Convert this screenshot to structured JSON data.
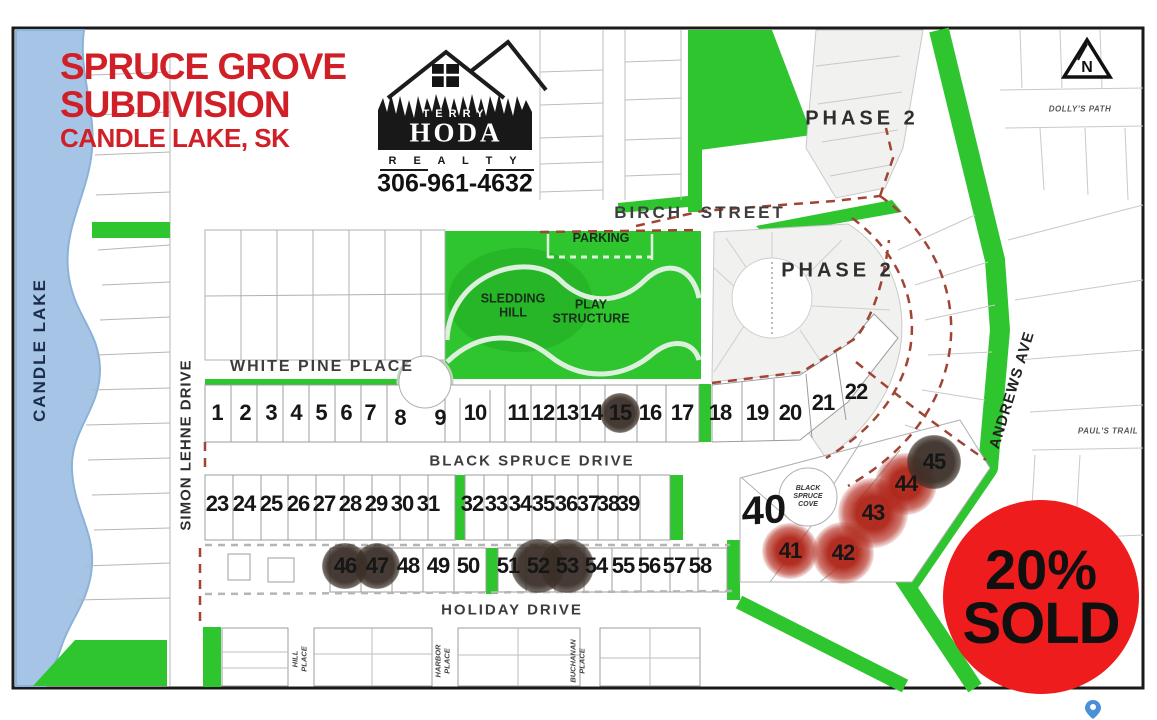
{
  "title": {
    "line1": "SPRUCE GROVE",
    "line2": "SUBDIVISION",
    "line3": "CANDLE LAKE, SK"
  },
  "logo": {
    "terry": "TERRY",
    "hoda": "HODA",
    "realty": "R E A L T Y",
    "phone": "306-961-4632"
  },
  "badge": {
    "percent": "20%",
    "sold": "SOLD"
  },
  "compass": {
    "letter": "N"
  },
  "labels": {
    "candle_lake": "CANDLE LAKE",
    "simon_lehne": "SIMON LEHNE DRIVE",
    "white_pine": "WHITE PINE PLACE",
    "birch": "BIRCH  STREET",
    "black_spruce_drive": "BLACK SPRUCE DRIVE",
    "holiday": "HOLIDAY DRIVE",
    "andrews": "ANDREWS AVE",
    "dollys_path": "DOLLY'S PATH",
    "pauls_trail": "PAUL'S TRAIL",
    "hill_place": "HILL\nPLACE",
    "harbor_place": "HARBOR\nPLACE",
    "buchanan_place": "BUCHANAN\nPLACE",
    "phase2_upper": "PHASE 2",
    "phase2_lower": "PHASE 2",
    "parking": "PARKING",
    "sledding_hill": "SLEDDING\nHILL",
    "play_structure": "PLAY\nSTRUCTURE",
    "black_spruce_cove": "BLACK\nSPRUCE\nCOVE",
    "lot40": "40"
  },
  "colors": {
    "green": "#2ec52e",
    "title_red": "#d01f27",
    "badge_red": "#ee1c1c",
    "lake_blue": "#a6c5e6",
    "boundary_dash": "#a04434",
    "sold_dark": "#3a2f27",
    "sold_red": "#af2316"
  },
  "lots": {
    "sold_dark_lots": [
      15,
      45,
      46,
      47,
      52,
      53
    ],
    "sold_red_lots": [
      41,
      42,
      43,
      44
    ],
    "items": [
      {
        "n": "1",
        "x": 217,
        "y": 413,
        "mark": "none"
      },
      {
        "n": "2",
        "x": 245,
        "y": 413,
        "mark": "none"
      },
      {
        "n": "3",
        "x": 271,
        "y": 413,
        "mark": "none"
      },
      {
        "n": "4",
        "x": 296,
        "y": 413,
        "mark": "none"
      },
      {
        "n": "5",
        "x": 321,
        "y": 413,
        "mark": "none"
      },
      {
        "n": "6",
        "x": 346,
        "y": 413,
        "mark": "none"
      },
      {
        "n": "7",
        "x": 370,
        "y": 413,
        "mark": "none"
      },
      {
        "n": "8",
        "x": 400,
        "y": 418,
        "mark": "none"
      },
      {
        "n": "9",
        "x": 440,
        "y": 418,
        "mark": "none"
      },
      {
        "n": "10",
        "x": 475,
        "y": 413,
        "mark": "none"
      },
      {
        "n": "11",
        "x": 518,
        "y": 413,
        "mark": "none"
      },
      {
        "n": "12",
        "x": 543,
        "y": 413,
        "mark": "none"
      },
      {
        "n": "13",
        "x": 567,
        "y": 413,
        "mark": "none"
      },
      {
        "n": "14",
        "x": 591,
        "y": 413,
        "mark": "none"
      },
      {
        "n": "15",
        "x": 620,
        "y": 413,
        "mark": "dark",
        "r": 20
      },
      {
        "n": "16",
        "x": 650,
        "y": 413,
        "mark": "none"
      },
      {
        "n": "17",
        "x": 682,
        "y": 413,
        "mark": "none"
      },
      {
        "n": "18",
        "x": 720,
        "y": 413,
        "mark": "none"
      },
      {
        "n": "19",
        "x": 757,
        "y": 413,
        "mark": "none"
      },
      {
        "n": "20",
        "x": 790,
        "y": 413,
        "mark": "none"
      },
      {
        "n": "21",
        "x": 823,
        "y": 403,
        "mark": "none"
      },
      {
        "n": "22",
        "x": 856,
        "y": 392,
        "mark": "none"
      },
      {
        "n": "23",
        "x": 217,
        "y": 504,
        "mark": "none"
      },
      {
        "n": "24",
        "x": 244,
        "y": 504,
        "mark": "none"
      },
      {
        "n": "25",
        "x": 271,
        "y": 504,
        "mark": "none"
      },
      {
        "n": "26",
        "x": 298,
        "y": 504,
        "mark": "none"
      },
      {
        "n": "27",
        "x": 324,
        "y": 504,
        "mark": "none"
      },
      {
        "n": "28",
        "x": 350,
        "y": 504,
        "mark": "none"
      },
      {
        "n": "29",
        "x": 376,
        "y": 504,
        "mark": "none"
      },
      {
        "n": "30",
        "x": 402,
        "y": 504,
        "mark": "none"
      },
      {
        "n": "31",
        "x": 428,
        "y": 504,
        "mark": "none"
      },
      {
        "n": "32",
        "x": 472,
        "y": 504,
        "mark": "none"
      },
      {
        "n": "33",
        "x": 496,
        "y": 504,
        "mark": "none"
      },
      {
        "n": "34",
        "x": 520,
        "y": 504,
        "mark": "none"
      },
      {
        "n": "35",
        "x": 543,
        "y": 504,
        "mark": "none"
      },
      {
        "n": "36",
        "x": 566,
        "y": 504,
        "mark": "none"
      },
      {
        "n": "37",
        "x": 588,
        "y": 504,
        "mark": "none"
      },
      {
        "n": "38",
        "x": 608,
        "y": 504,
        "mark": "none"
      },
      {
        "n": "39",
        "x": 628,
        "y": 504,
        "mark": "none"
      },
      {
        "n": "41",
        "x": 790,
        "y": 551,
        "mark": "red",
        "r": 28
      },
      {
        "n": "42",
        "x": 843,
        "y": 553,
        "mark": "red",
        "r": 31
      },
      {
        "n": "43",
        "x": 873,
        "y": 513,
        "mark": "red",
        "r": 35
      },
      {
        "n": "44",
        "x": 906,
        "y": 484,
        "mark": "red",
        "r": 31
      },
      {
        "n": "45",
        "x": 934,
        "y": 462,
        "mark": "dark",
        "r": 27
      },
      {
        "n": "46",
        "x": 345,
        "y": 566,
        "mark": "dark",
        "r": 23
      },
      {
        "n": "47",
        "x": 377,
        "y": 566,
        "mark": "dark",
        "r": 23
      },
      {
        "n": "48",
        "x": 408,
        "y": 566,
        "mark": "none"
      },
      {
        "n": "49",
        "x": 438,
        "y": 566,
        "mark": "none"
      },
      {
        "n": "50",
        "x": 468,
        "y": 566,
        "mark": "none"
      },
      {
        "n": "51",
        "x": 508,
        "y": 566,
        "mark": "none"
      },
      {
        "n": "52",
        "x": 538,
        "y": 566,
        "mark": "dark",
        "r": 27
      },
      {
        "n": "53",
        "x": 567,
        "y": 566,
        "mark": "dark",
        "r": 27
      },
      {
        "n": "54",
        "x": 596,
        "y": 566,
        "mark": "none"
      },
      {
        "n": "55",
        "x": 623,
        "y": 566,
        "mark": "none"
      },
      {
        "n": "56",
        "x": 649,
        "y": 566,
        "mark": "none"
      },
      {
        "n": "57",
        "x": 674,
        "y": 566,
        "mark": "none"
      },
      {
        "n": "58",
        "x": 700,
        "y": 566,
        "mark": "none"
      }
    ]
  }
}
